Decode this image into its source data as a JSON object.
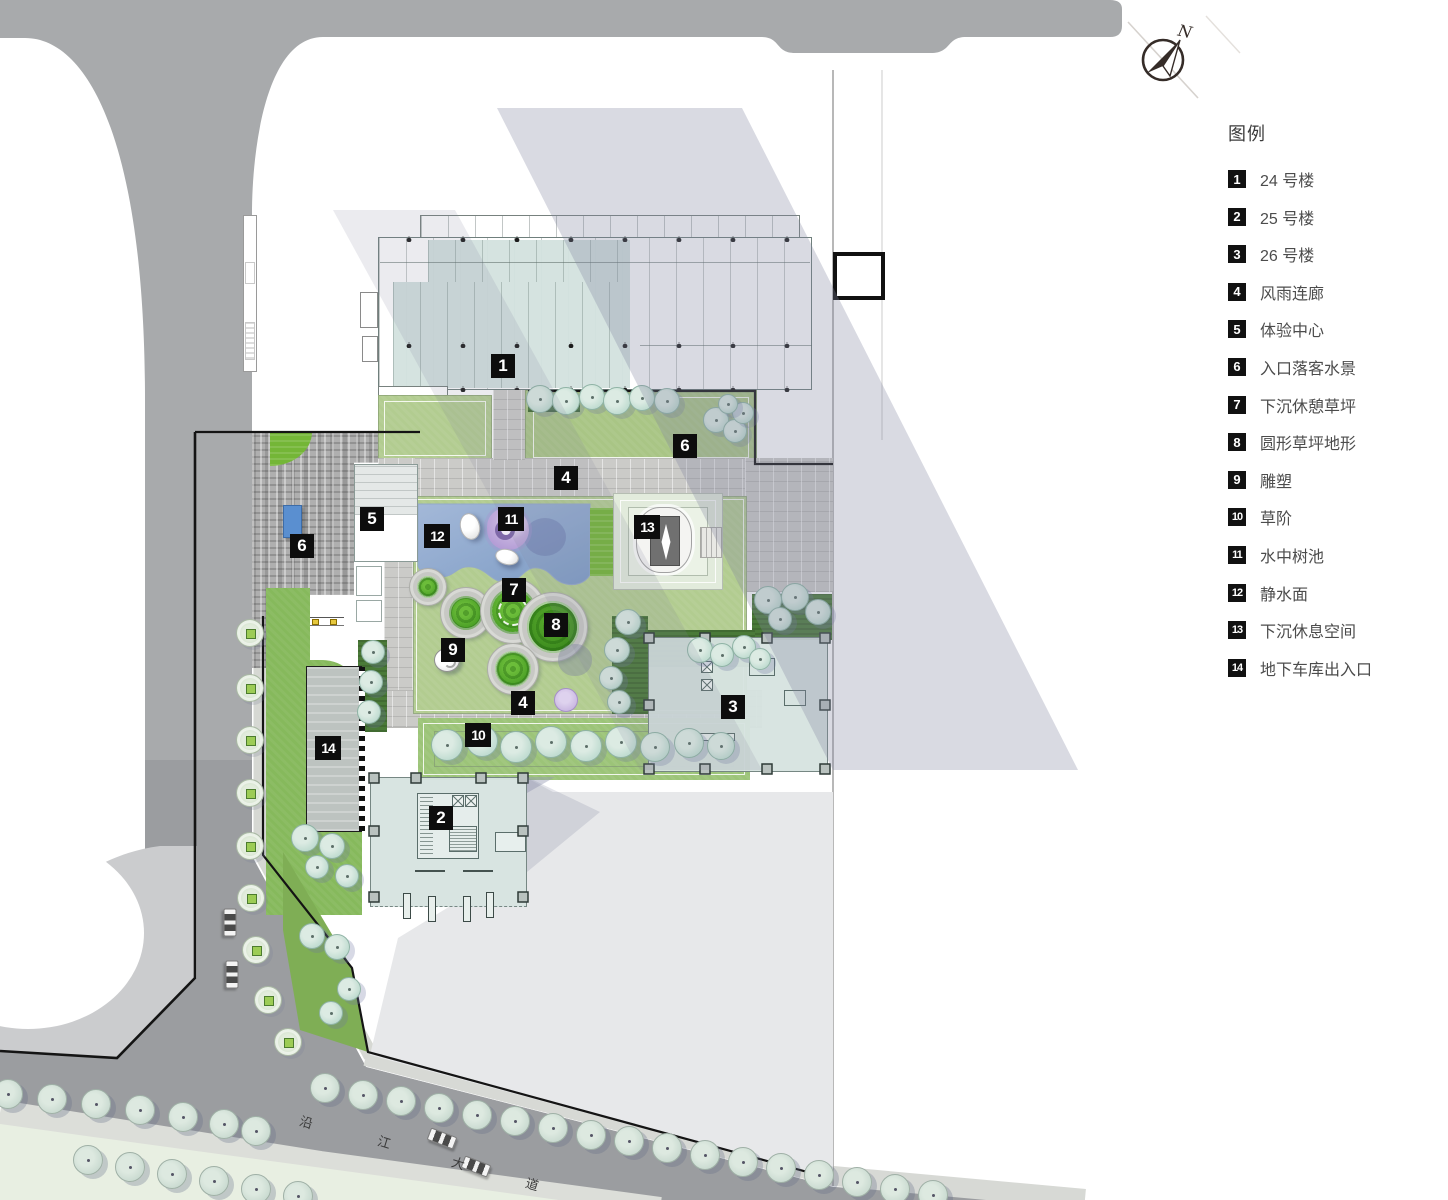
{
  "legend": {
    "title": "图例",
    "items": [
      {
        "num": "1",
        "label": "24 号楼"
      },
      {
        "num": "2",
        "label": "25 号楼"
      },
      {
        "num": "3",
        "label": "26 号楼"
      },
      {
        "num": "4",
        "label": "风雨连廊"
      },
      {
        "num": "5",
        "label": "体验中心"
      },
      {
        "num": "6",
        "label": "入口落客水景"
      },
      {
        "num": "7",
        "label": "下沉休憩草坪"
      },
      {
        "num": "8",
        "label": "圆形草坪地形"
      },
      {
        "num": "9",
        "label": "雕塑"
      },
      {
        "num": "10",
        "label": "草阶"
      },
      {
        "num": "11",
        "label": "水中树池"
      },
      {
        "num": "12",
        "label": "静水面"
      },
      {
        "num": "13",
        "label": "下沉休息空间"
      },
      {
        "num": "14",
        "label": "地下车库出入口"
      }
    ]
  },
  "compass": {
    "label": "N"
  },
  "road": {
    "name": "沿江大道",
    "chars": [
      "沿",
      "江",
      "大",
      "道"
    ]
  },
  "plan_markers": [
    {
      "n": "1",
      "x": 503,
      "y": 366
    },
    {
      "n": "2",
      "x": 441,
      "y": 818
    },
    {
      "n": "3",
      "x": 733,
      "y": 707
    },
    {
      "n": "4",
      "x": 566,
      "y": 478
    },
    {
      "n": "4",
      "x": 523,
      "y": 703
    },
    {
      "n": "5",
      "x": 372,
      "y": 519
    },
    {
      "n": "6",
      "x": 685,
      "y": 446
    },
    {
      "n": "6",
      "x": 302,
      "y": 546
    },
    {
      "n": "7",
      "x": 514,
      "y": 590
    },
    {
      "n": "8",
      "x": 556,
      "y": 625
    },
    {
      "n": "9",
      "x": 453,
      "y": 650
    },
    {
      "n": "10",
      "x": 478,
      "y": 735
    },
    {
      "n": "11",
      "x": 511,
      "y": 519
    },
    {
      "n": "12",
      "x": 437,
      "y": 536
    },
    {
      "n": "13",
      "x": 647,
      "y": 527
    },
    {
      "n": "14",
      "x": 328,
      "y": 748
    }
  ],
  "colors": {
    "building_fill": "#d6e3e0",
    "pond": "#7e9cc5",
    "lawn": "#b2cc90",
    "mound_green": "#54a62a",
    "road": "#a8aaac",
    "plaza": "#b0b0b0",
    "marker_bg": "#0d0d0d",
    "legend_text": "#4c4c4c",
    "water_accent": "#5a8fd0"
  }
}
